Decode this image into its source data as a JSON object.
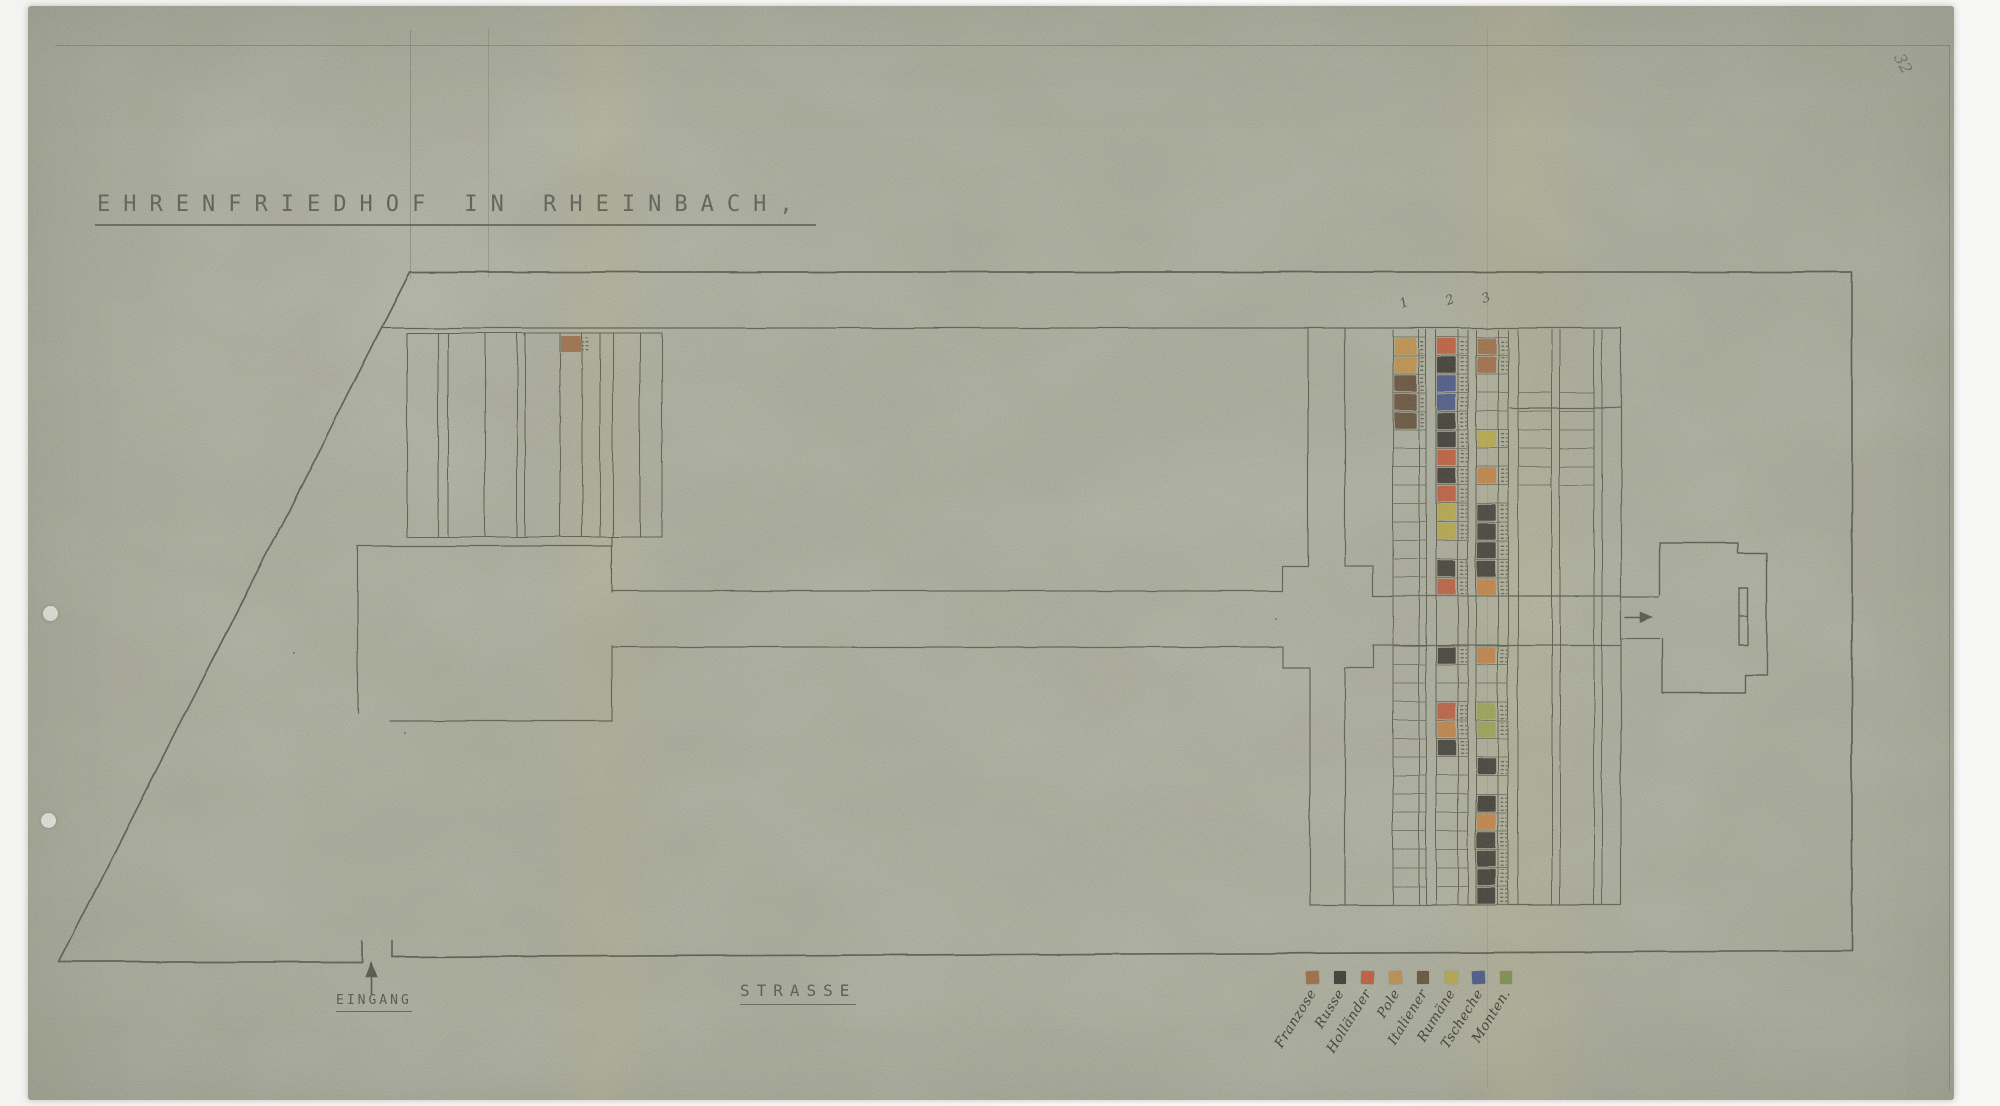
{
  "page": {
    "title": "EHRENFRIEDHOF IN RHEINBACH,",
    "corner_mark": "32",
    "entrance_label": "EINGANG",
    "street_label": "STRASSE",
    "section_numbers": [
      "1",
      "2",
      "3"
    ]
  },
  "legend": {
    "entries": [
      {
        "key": "franzose",
        "label": "Franzose",
        "color": "#a4683c"
      },
      {
        "key": "russe",
        "label": "Russe",
        "color": "#2e2d28"
      },
      {
        "key": "hollaender",
        "label": "Holländer",
        "color": "#cb5434"
      },
      {
        "key": "pole",
        "label": "Pole",
        "color": "#c99243"
      },
      {
        "key": "italiener",
        "label": "Italiener",
        "color": "#5f462c"
      },
      {
        "key": "rumaene",
        "label": "Rumäne",
        "color": "#c2b13e"
      },
      {
        "key": "tscheche",
        "label": "Tscheche",
        "color": "#3c508c"
      },
      {
        "key": "montenegriner",
        "label": "Monten.",
        "color": "#7d9347"
      }
    ]
  },
  "grave_field": {
    "palette": {
      "F": "#a4683c",
      "R": "#2e2d28",
      "H": "#cb5434",
      "P": "#c99243",
      "I": "#5f462c",
      "U": "#c2b13e",
      "T": "#3c508c",
      "M": "#7d9347",
      "O": "#d0823a",
      "G": "#9dac4d"
    },
    "left_block_marker": "F",
    "sections": {
      "top": {
        "col1": [
          "P",
          "P",
          "I",
          "I",
          "I",
          "",
          "",
          "",
          "",
          "",
          "",
          "",
          "",
          ""
        ],
        "col2": [
          "H",
          "R",
          "T",
          "T",
          "R",
          "R",
          "H",
          "R",
          "H",
          "U",
          "U",
          "",
          "R",
          "H"
        ],
        "col3": [
          "F",
          "F",
          "",
          "",
          "",
          "U",
          "",
          "O",
          "",
          "R",
          "R",
          "R",
          "R",
          "O"
        ]
      },
      "bottom": {
        "col1": [
          "",
          "",
          "",
          "",
          "",
          "",
          "",
          "",
          "",
          "",
          "",
          "",
          "",
          ""
        ],
        "col2": [
          "R",
          "",
          "",
          "H",
          "O",
          "R",
          "",
          "",
          "",
          "",
          "",
          "",
          "",
          ""
        ],
        "col3": [
          "O",
          "",
          "",
          "G",
          "G",
          "",
          "R",
          "",
          "R",
          "O",
          "R",
          "R",
          "R",
          "R"
        ]
      }
    }
  }
}
